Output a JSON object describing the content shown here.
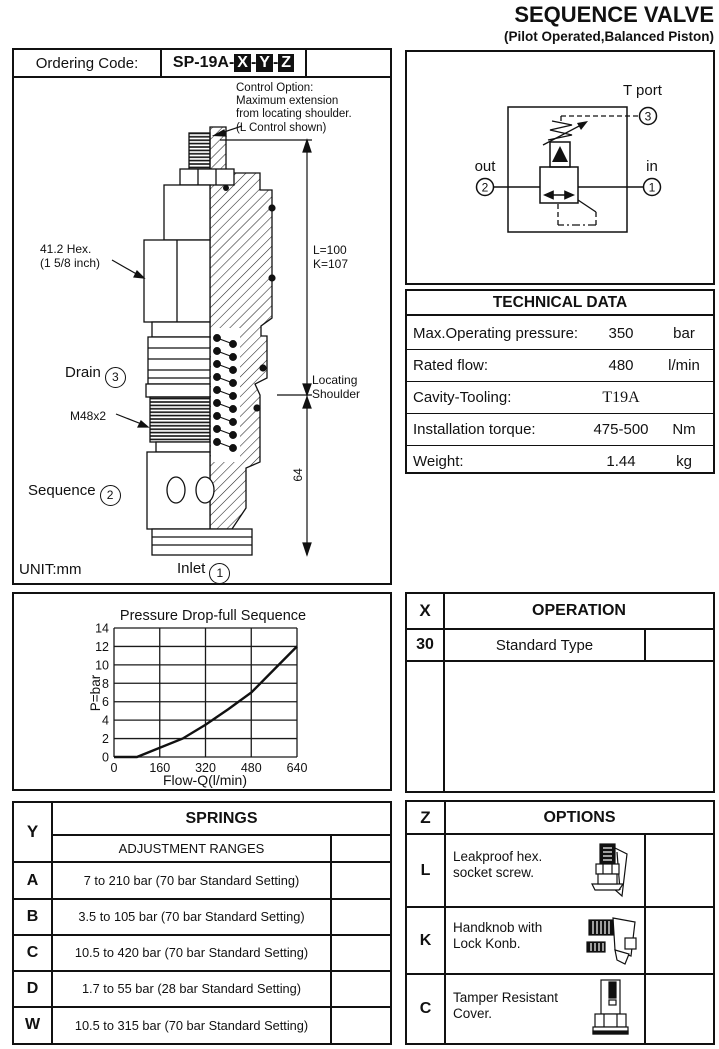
{
  "page": {
    "title": "SEQUENCE VALVE",
    "subtitle": "(Pilot Operated,Balanced Piston)"
  },
  "ordering": {
    "label": "Ordering Code:",
    "code_prefix": "SP-19A-",
    "code_vars": [
      "X",
      "Y",
      "Z"
    ],
    "separator": "-"
  },
  "drawing": {
    "control_note": "Control Option:\nMaximum extension\nfrom locating shoulder.\n(L Control shown)",
    "hex_note": "41.2 Hex.\n(1 5/8 inch)",
    "dims_lk": "L=100\nK=107",
    "drain_label": "Drain",
    "drain_port": "3",
    "thread_label": "M48x2",
    "sequence_label": "Sequence",
    "sequence_port": "2",
    "locating_note": "Locating\nShoulder",
    "dim_64": "64",
    "inlet_label": "Inlet",
    "inlet_port": "1",
    "unit_label": "UNIT:mm"
  },
  "schematic": {
    "t_port_label": "T port",
    "t_port_num": "3",
    "out_label": "out",
    "out_num": "2",
    "in_label": "in",
    "in_num": "1"
  },
  "technical_data": {
    "title": "TECHNICAL DATA",
    "rows": [
      {
        "label": "Max.Operating pressure:",
        "value": "350",
        "unit": "bar"
      },
      {
        "label": "Rated flow:",
        "value": "480",
        "unit": "l/min"
      },
      {
        "label": "Cavity-Tooling:",
        "value": "T19A",
        "unit": ""
      },
      {
        "label": "Installation torque:",
        "value": "475-500",
        "unit": "Nm"
      },
      {
        "label": "Weight:",
        "value": "1.44",
        "unit": "kg"
      }
    ]
  },
  "chart_data": {
    "type": "line",
    "title": "Pressure Drop-full Sequence",
    "xlabel": "Flow-Q(l/min)",
    "ylabel": "P=bar",
    "xlim": [
      0,
      640
    ],
    "ylim": [
      0,
      14
    ],
    "x_ticks": [
      0,
      160,
      320,
      480,
      640
    ],
    "y_ticks": [
      0,
      2,
      4,
      6,
      8,
      10,
      12,
      14
    ],
    "grid": true,
    "legend_position": "none",
    "series": [
      {
        "name": "Pressure Drop-full Sequence",
        "x": [
          0,
          80,
          160,
          240,
          320,
          400,
          480,
          560,
          640
        ],
        "y": [
          0,
          0,
          1,
          2,
          3.5,
          5.2,
          7,
          9.5,
          12
        ]
      }
    ]
  },
  "operation": {
    "col_header": "X",
    "title": "OPERATION",
    "rows": [
      {
        "code": "30",
        "label": "Standard Type"
      }
    ]
  },
  "springs": {
    "col_header": "Y",
    "title": "SPRINGS",
    "subtitle": "ADJUSTMENT RANGES",
    "rows": [
      {
        "code": "A",
        "range": "7 to 210 bar  (70 bar Standard Setting)"
      },
      {
        "code": "B",
        "range": "3.5 to 105 bar  (70 bar Standard Setting)"
      },
      {
        "code": "C",
        "range": "10.5 to 420 bar  (70 bar Standard Setting)"
      },
      {
        "code": "D",
        "range": "1.7 to  55  bar  (28 bar Standard Setting)"
      },
      {
        "code": "W",
        "range": "10.5 to  315 bar  (70 bar Standard Setting)"
      }
    ]
  },
  "options": {
    "col_header": "Z",
    "title": "OPTIONS",
    "rows": [
      {
        "code": "L",
        "label": "Leakproof hex.\nsocket screw.",
        "icon": "hex-socket-screw-icon"
      },
      {
        "code": "K",
        "label": "Handknob with\nLock Konb.",
        "icon": "handknob-icon"
      },
      {
        "code": "C",
        "label": "Tamper Resistant\nCover.",
        "icon": "tamper-cover-icon"
      }
    ]
  }
}
